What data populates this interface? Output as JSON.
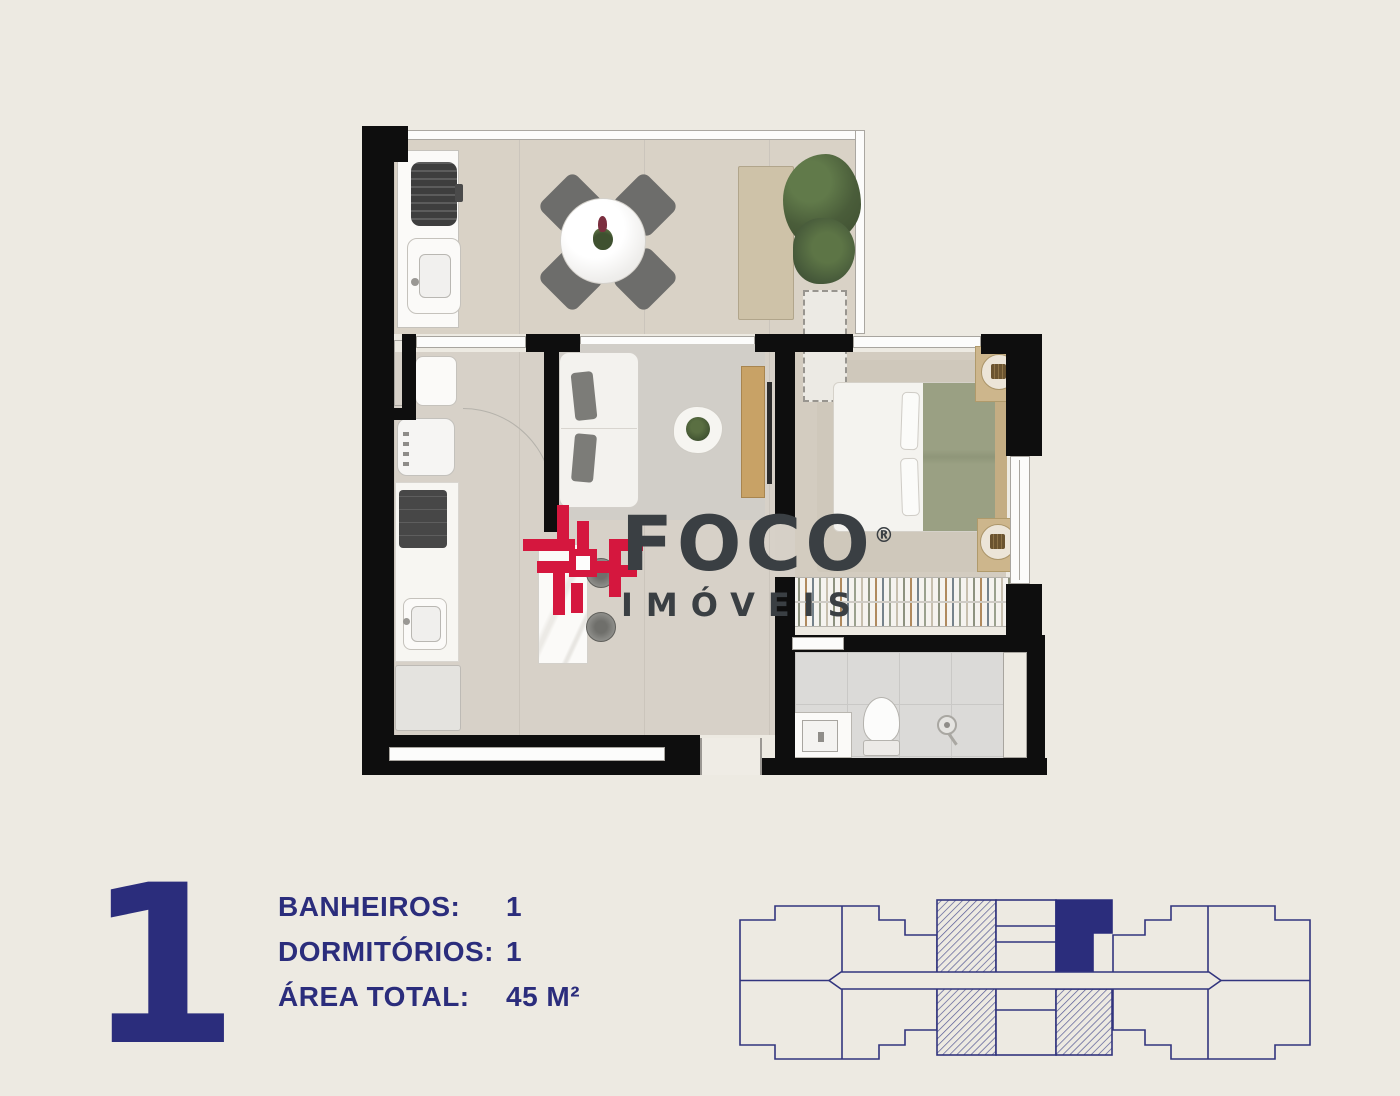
{
  "page": {
    "background_color": "#edeae2"
  },
  "logo": {
    "brand": "FOCO",
    "registered": "®",
    "subtitle": "IMÓVEIS",
    "accent_color": "#d5173e",
    "text_color": "#3a3f43"
  },
  "unit_info": {
    "unit_number": "1",
    "rows": [
      {
        "label": "BANHEIROS:",
        "value": "1"
      },
      {
        "label": "DORMITÓRIOS:",
        "value": "1"
      },
      {
        "label": "ÁREA TOTAL:",
        "value": "45 M²"
      }
    ],
    "text_color": "#2b2d7c"
  },
  "floor_plan": {
    "wall_color": "#0e0e0e",
    "balcony_floor_color": "#d9d2c6",
    "interior_floor_color": "#d7d1c8",
    "bedroom_floor_color": "#d3ccc0",
    "bathroom_floor_color": "#dbdad8",
    "wood_accent_color": "#c8a266",
    "blanket_color": "#9aa083"
  },
  "key_plan": {
    "outline_color": "#32357e",
    "highlight_color": "#2b2d7c"
  }
}
